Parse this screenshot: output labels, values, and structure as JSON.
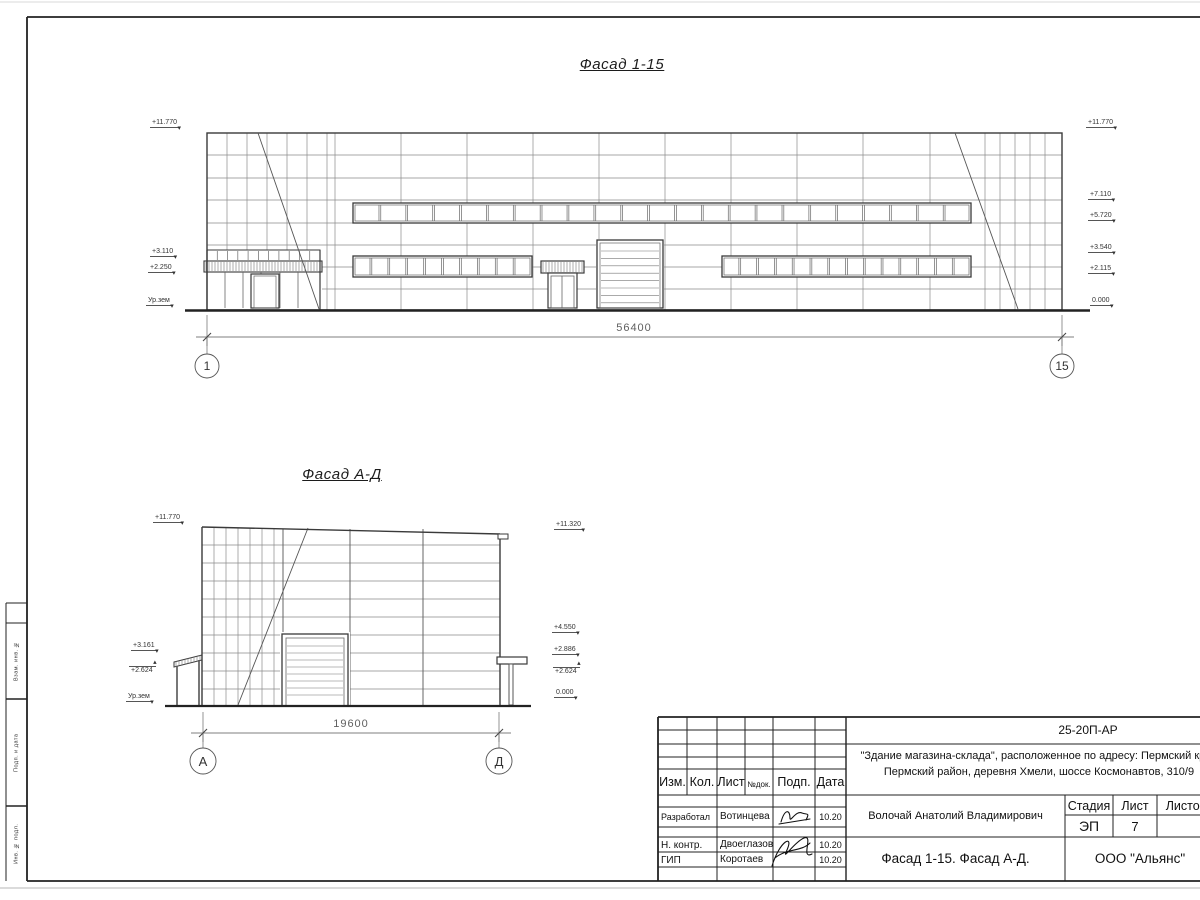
{
  "drawing1": {
    "title": "Фасад 1-15",
    "dimension": "56400",
    "axis_left": "1",
    "axis_right": "15",
    "marks_left": [
      "+11.770",
      "+3.110",
      "+2.250",
      "Ур.зем"
    ],
    "marks_right": [
      "+11.770",
      "+7.110",
      "+5.720",
      "+3.540",
      "+2.115",
      "0.000"
    ]
  },
  "drawing2": {
    "title": "Фасад А-Д",
    "dimension": "19600",
    "axis_left": "А",
    "axis_right": "Д",
    "marks_left": [
      "+11.770",
      "+3.161",
      "+2.624",
      "Ур.зем"
    ],
    "marks_right": [
      "+11.320",
      "+4.550",
      "+2.886",
      "+2.624",
      "0.000"
    ]
  },
  "side_stamp": {
    "labels": [
      "Взам. инв. №",
      "Подп. и дата",
      "Инв. № подл."
    ]
  },
  "title_block": {
    "code": "25-20П-АР",
    "project_line1": "\"Здание магазина-склада\", расположенное по адресу: Пермский край",
    "project_line2": "Пермский район, деревня Хмели, шоссе Космонавтов, 310/9",
    "header": {
      "izm": "Изм.",
      "kol": "Кол.",
      "list": "Лист",
      "ndok": "№док.",
      "podp": "Подп.",
      "data": "Дата"
    },
    "rows": [
      {
        "role": "Разработал",
        "name": "Вотинцева",
        "date": "10.20"
      },
      {
        "role": "Н. контр.",
        "name": "Двоеглазов",
        "date": "10.20"
      },
      {
        "role": "ГИП",
        "name": "Коротаев",
        "date": "10.20"
      }
    ],
    "chief": "Волочай Анатолий Владимирович",
    "stage_label": "Стадия",
    "sheet_label": "Лист",
    "sheets_label": "Листов",
    "stage": "ЭП",
    "sheet_no": "7",
    "doc_title": "Фасад 1-15. Фасад А-Д.",
    "company": "ООО \"Альянс\"",
    "colors": {
      "line": "#222222",
      "grid": "#8a8a8a",
      "outline": "#3a3a3a"
    }
  }
}
